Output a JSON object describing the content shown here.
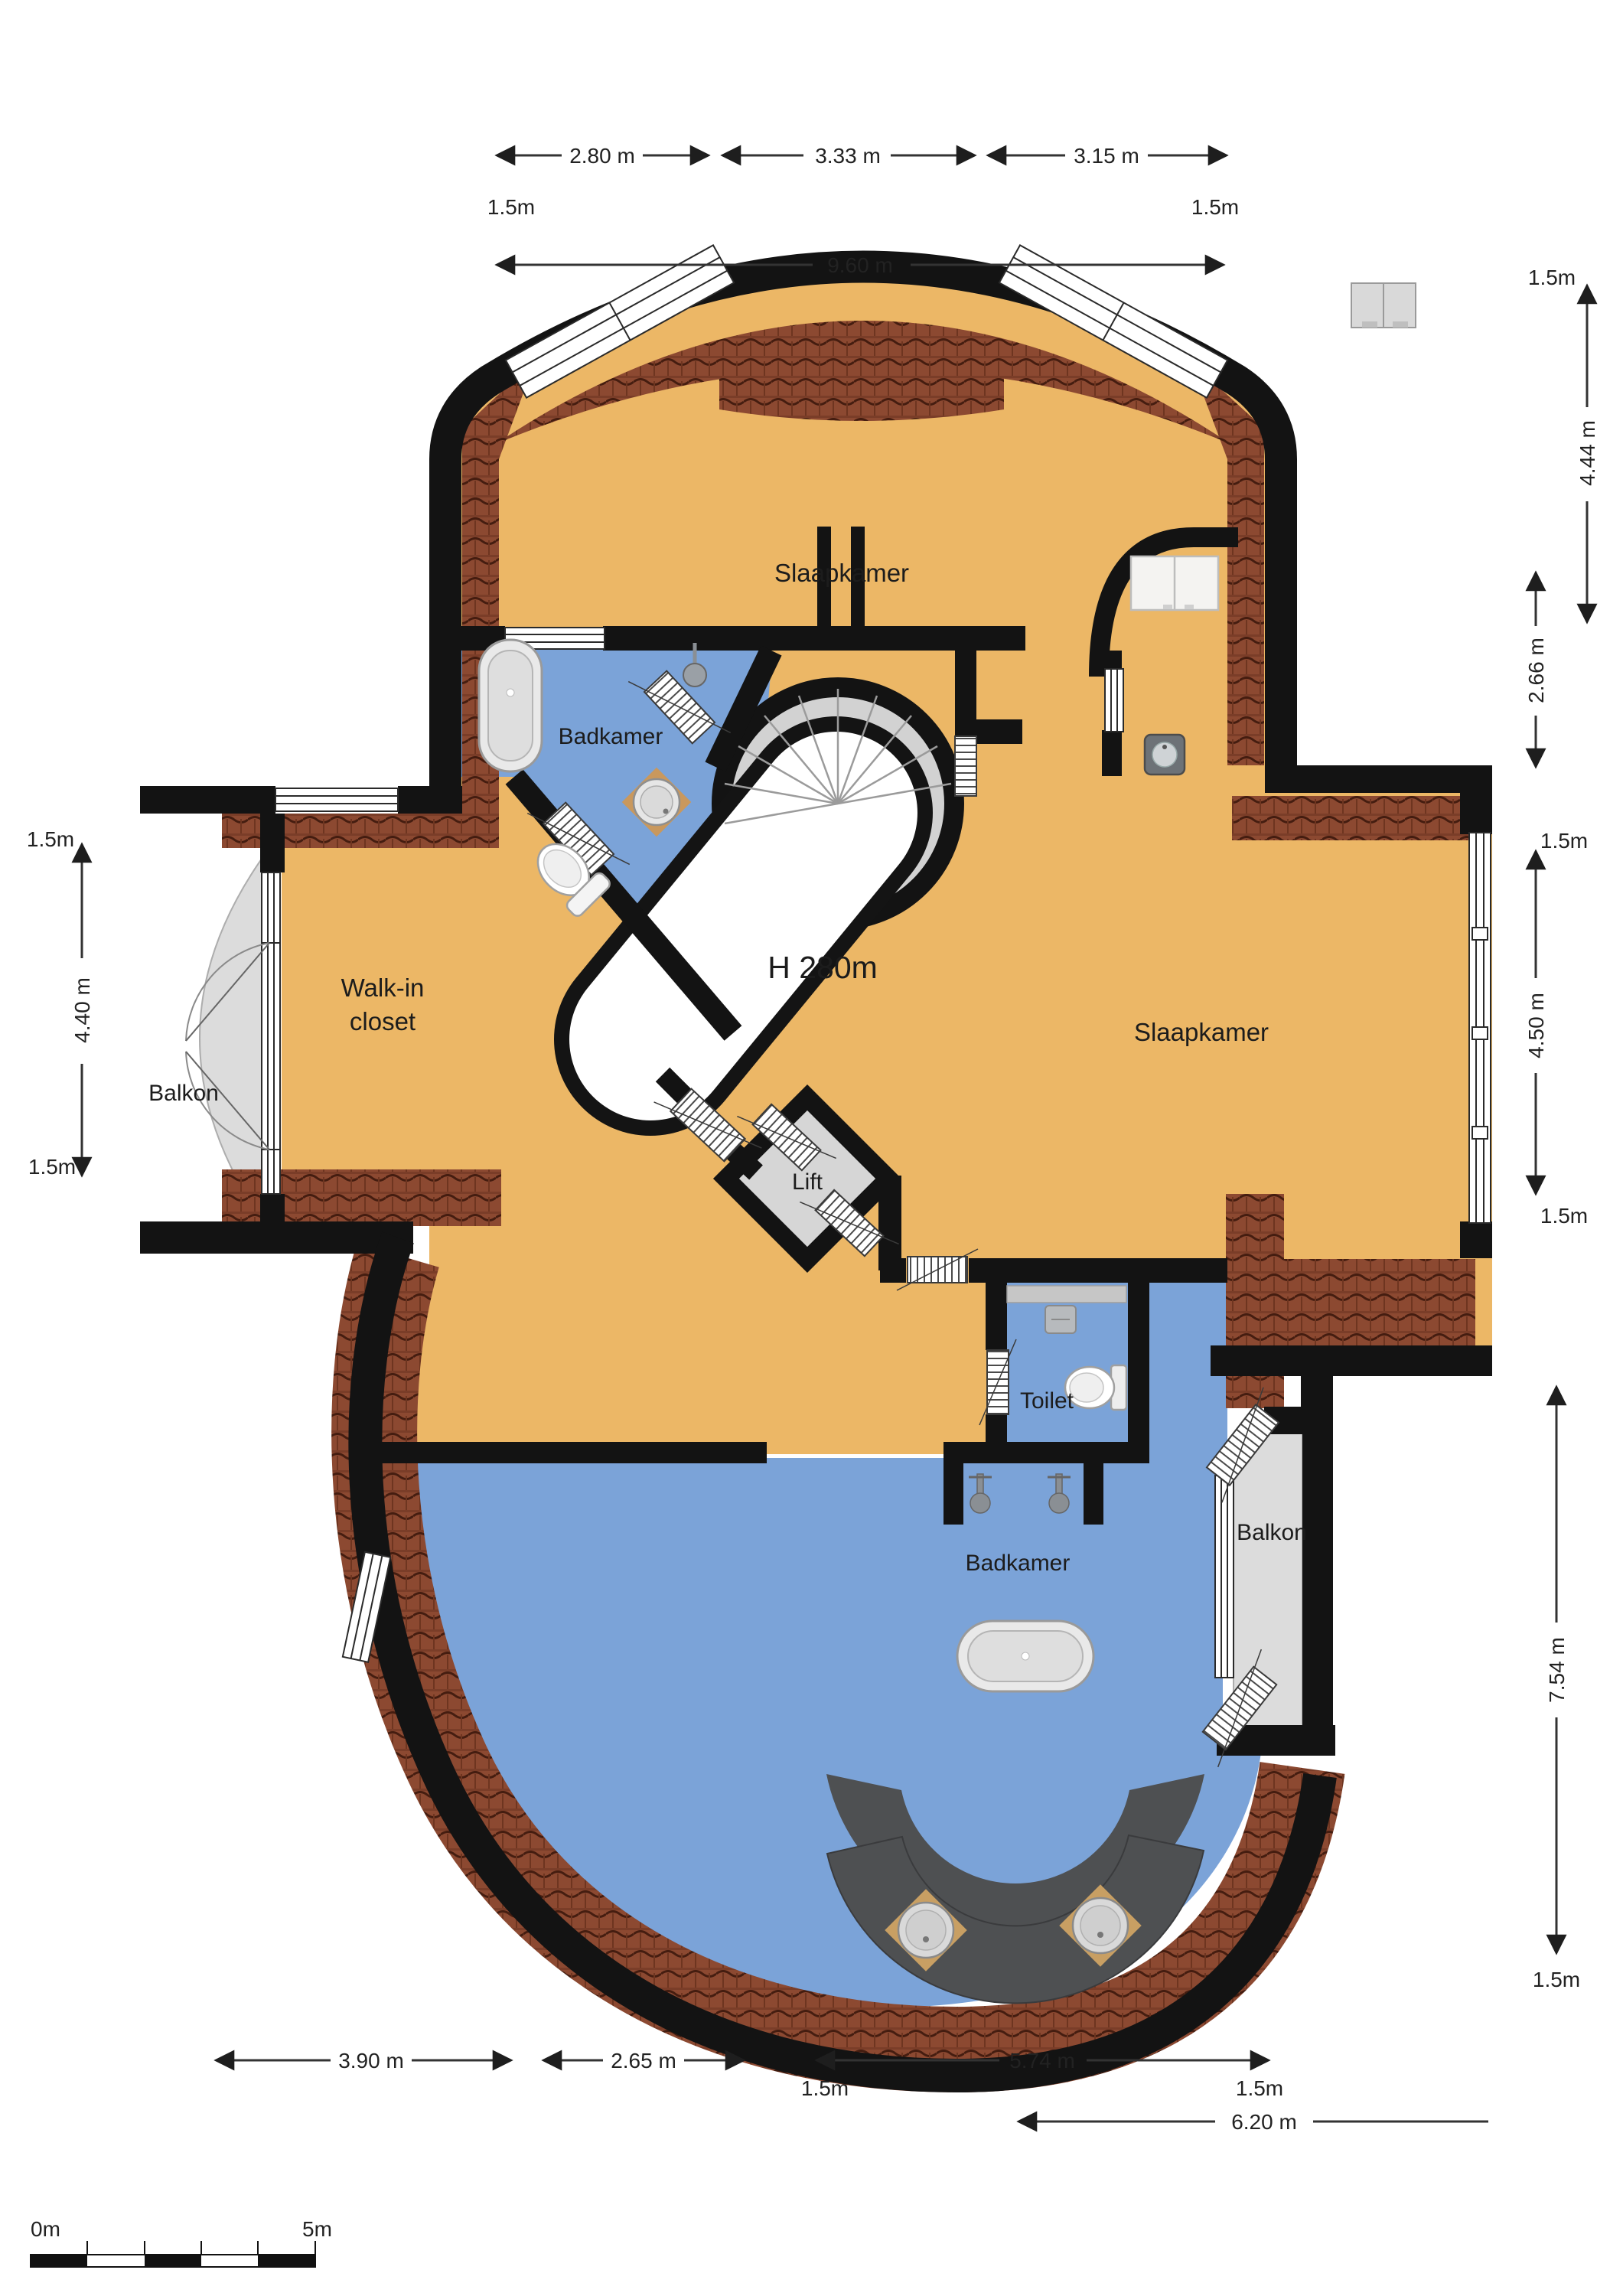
{
  "plan": {
    "type": "floorplan",
    "rooms": {
      "bedroom_top": "Slaapkamer",
      "bathroom_top": "Badkamer",
      "walk_in_closet_line1": "Walk-in",
      "walk_in_closet_line2": "closet",
      "balcony_left": "Balkon",
      "bedroom_right": "Slaapkamer",
      "ceiling_height": "H 280m",
      "lift": "Lift",
      "toilet": "Toilet",
      "bathroom_bottom": "Badkamer",
      "balcony_right": "Balkon"
    },
    "dimensions": {
      "top_segment_1": "2.80 m",
      "top_segment_2": "3.33 m",
      "top_segment_3": "3.15 m",
      "top_margin_left": "1.5m",
      "top_margin_right": "1.5m",
      "top_total": "9.60 m",
      "right_margin_top": "1.5m",
      "right_upper": "4.44 m",
      "right_mid": "2.66 m",
      "right_margin_mid_top": "1.5m",
      "right_bedroom": "4.50 m",
      "right_margin_mid_bottom": "1.5m",
      "right_lower": "7.54 m",
      "right_margin_bottom": "1.5m",
      "left_margin_top": "1.5m",
      "left_height": "4.40 m",
      "left_margin_bottom": "1.5m",
      "bottom_left": "3.90 m",
      "bottom_mid": "2.65 m",
      "bottom_margin_left": "1.5m",
      "bottom_bath": "5.74 m",
      "bottom_margin_right": "1.5m",
      "bottom_total": "6.20 m"
    },
    "scale_bar": {
      "start": "0m",
      "end": "5m"
    },
    "colors": {
      "floor": "#ECB766",
      "wet_floor": "#7BA3D8",
      "roof_tiles": "#8C4931",
      "wall": "#131313",
      "balcony": "#DCDCDC",
      "stairs": "#D2D2D2",
      "counter": "#4E5052"
    }
  }
}
